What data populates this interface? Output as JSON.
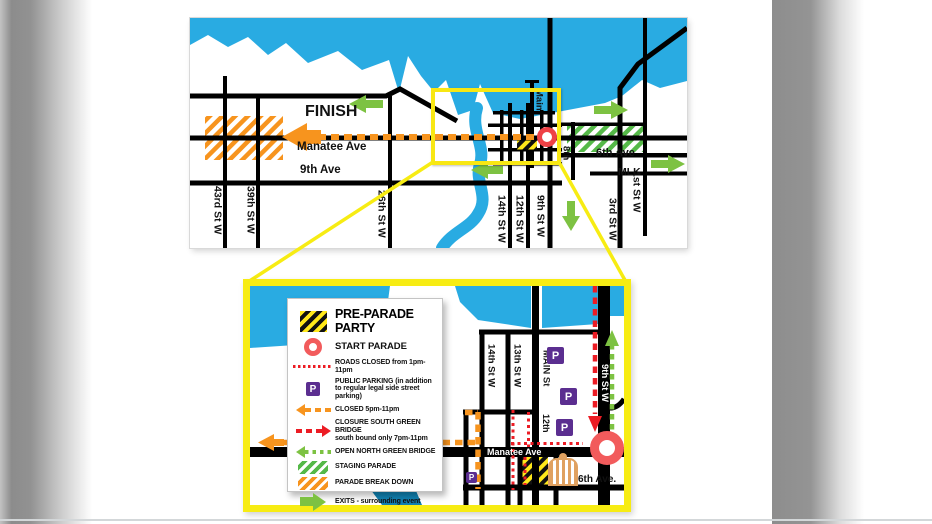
{
  "overview": {
    "finish": "FINISH",
    "manatee_ave": "Manatee Ave",
    "ninth_ave": "9th Ave",
    "sixth_ave": "6th Ave",
    "mlk": "MLK",
    "streets": {
      "s43": "43rd St W",
      "s39": "39th St W",
      "s26": "26th St W",
      "s14": "14th St W",
      "s12": "12th St W",
      "s9": "9th St W",
      "s8": "8th",
      "s3": "3rd St W",
      "s1": "1st St W",
      "main": "Main"
    }
  },
  "inset": {
    "streets": {
      "s14": "14th St W",
      "s13": "13th St W",
      "main": "MAIN St",
      "s12": "12th",
      "s9": "9th St W"
    },
    "manatee_ave": "Manatee Ave",
    "sixth_ave": "6th Ave.",
    "parking_letter": "P"
  },
  "legend": {
    "title": "PRE-PARADE PARTY",
    "parking_letter": "P",
    "items": {
      "start": "START PARADE",
      "roads_closed": "ROADS CLOSED from 1pm-11pm",
      "public_parking": "PUBLIC PARKING (in addition to regular legal side street parking)",
      "closed": "CLOSED 5pm-11pm",
      "closure_line1": "CLOSURE SOUTH GREEN BRIDGE",
      "closure_line2": "south bound only 7pm-11pm",
      "open_bridge": "OPEN NORTH GREEN BRIDGE",
      "staging": "STAGING PARADE",
      "breakdown": "PARADE BREAK DOWN",
      "exits": "EXITS - surrounding event"
    }
  },
  "colors": {
    "water": "#29ABE2",
    "water_dark": "#1080B0",
    "road": "#000000",
    "orange": "#F7941E",
    "red": "#EC1C24",
    "coral": "#F25B5C",
    "green_arrow": "#7DC242",
    "green_hatch": "#55B948",
    "purple": "#5B2E90",
    "yellow": "#F7EC13"
  }
}
